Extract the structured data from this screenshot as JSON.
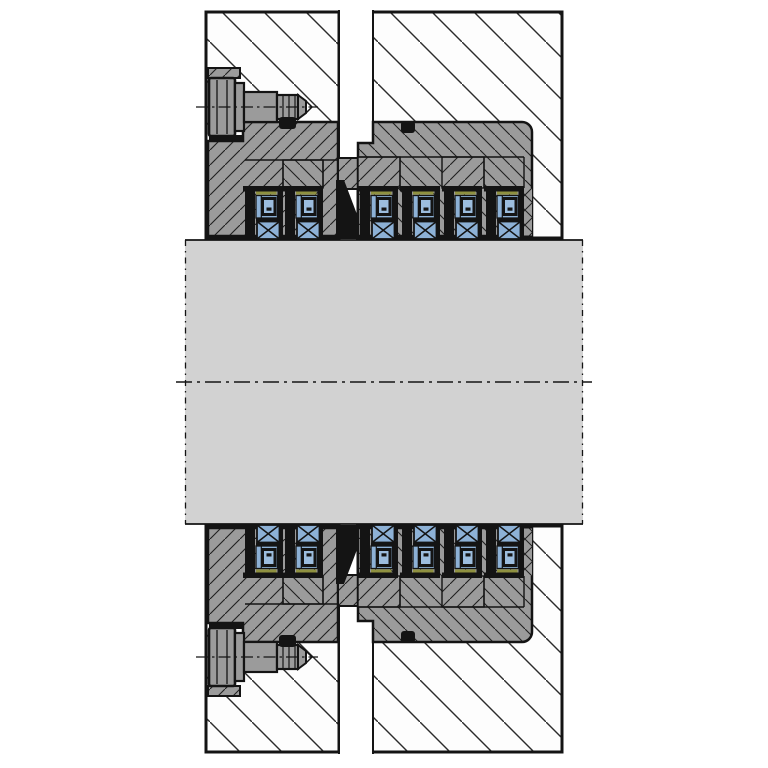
{
  "figure": {
    "title": "Radial shaft sealing assembly — cross-section drawing",
    "description": "Engineering cross-section of a split housing with upper and lower gland flanges bolted in place, twelve spring-energized seal cartridges (six above, six below) riding on a large cylindrical shaft sleeve, two O-rings per gland, hatched housing halves and a dash-dot shaft centerline.",
    "type": "technical-drawing",
    "view": "section"
  },
  "counts": {
    "seal_cartridges_top": 6,
    "seal_cartridges_bottom": 6,
    "bolts": 2,
    "o_rings": 4,
    "housing_halves": 2
  },
  "components": [
    {
      "name": "upper-housing-left-block",
      "material": "section-hatched"
    },
    {
      "name": "upper-housing-right-block",
      "material": "section-hatched"
    },
    {
      "name": "upper-vent-slot",
      "material": "void"
    },
    {
      "name": "upper-gland-flange",
      "material": "steel"
    },
    {
      "name": "upper-gland-body",
      "material": "steel"
    },
    {
      "name": "hex-bolt-upper",
      "material": "steel"
    },
    {
      "name": "o-ring-upper-left",
      "material": "elastomer"
    },
    {
      "name": "o-ring-upper-right",
      "material": "elastomer"
    },
    {
      "name": "seal-cartridge",
      "material": "PTFE/elastomer",
      "repeat": 12
    },
    {
      "name": "shaft-sleeve",
      "material": "steel"
    },
    {
      "name": "lower-assembly",
      "material": "mirror-of-upper"
    }
  ],
  "colors": {
    "paper": "#ffffff",
    "housing_fill": "#fdfdfd",
    "hatch_line": "#2b2b2b",
    "metal_gray": "#9b9b9b",
    "metal_hatch": "#1f1f1f",
    "shaft_gray": "#d2d2d2",
    "seal_blue": "#8db1d6",
    "spring_blue": "#9cbdde",
    "accent_olive": "#8f9140",
    "ink": "#141414"
  }
}
